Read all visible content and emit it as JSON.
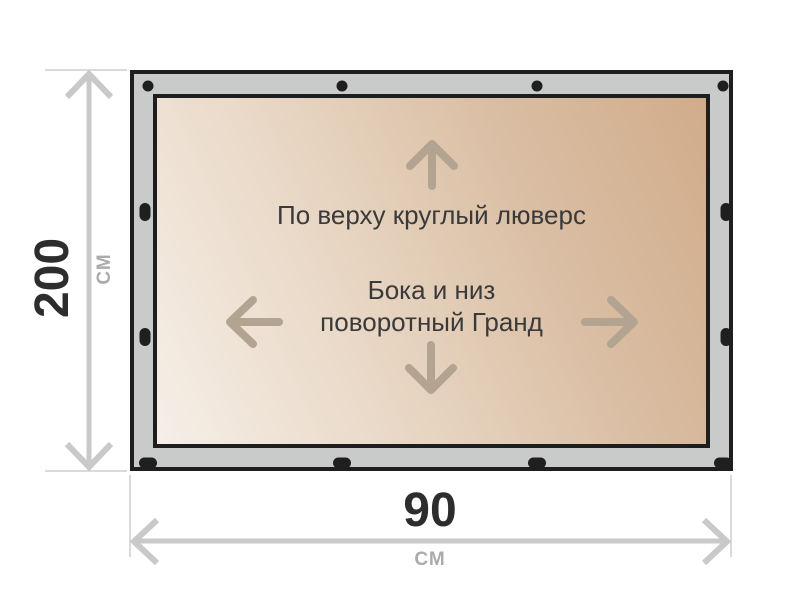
{
  "banner": {
    "top_note": "По верху круглый люверс",
    "center_note_line1": "Бока и низ",
    "center_note_line2": "поворотный Гранд"
  },
  "dimensions": {
    "height": {
      "value": "200",
      "unit": "СМ"
    },
    "width": {
      "value": "90",
      "unit": "СМ"
    }
  },
  "icons": {
    "canvas_arrows": [
      "arrow-up-icon",
      "arrow-left-icon",
      "arrow-right-icon",
      "arrow-down-icon"
    ],
    "dimension_arrowheads": [
      "arrow-up-icon",
      "arrow-down-icon",
      "arrow-left-icon",
      "arrow-right-icon"
    ],
    "grommets": {
      "top_round": 4,
      "bottom_oval": 4,
      "left_oval": 2,
      "right_oval": 2
    }
  },
  "colors": {
    "background": "#ffffff",
    "frame_fill": "#c9cbca",
    "frame_border": "#1e1e1e",
    "grommet": "#1f1f1f",
    "canvas_gradient_light": "#f6efe8",
    "canvas_gradient_dark": "#d1ac8a",
    "canvas_arrow": "#b2a491",
    "note_text": "#3a3a3a",
    "dimension_value_text": "#2d2d2d",
    "dimension_unit_text": "#ababab",
    "dimension_line": "#c9c9c9",
    "extension_line": "#dadada"
  }
}
